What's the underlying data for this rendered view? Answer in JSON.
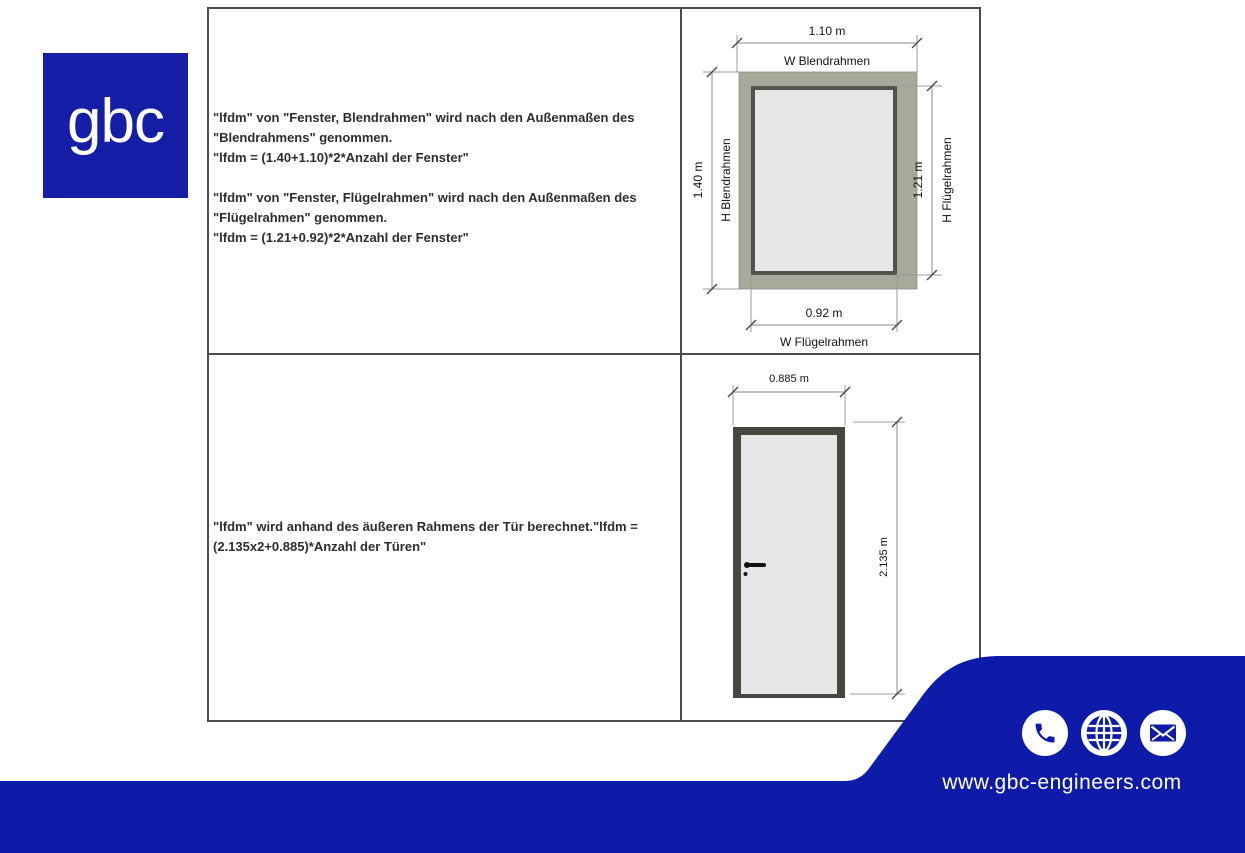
{
  "logo": {
    "text": "gbc"
  },
  "colors": {
    "brand_blue": "#0e1ba8",
    "logo_blue": "#161da7",
    "window_outer_frame": "#a8a99b",
    "window_inner_frame": "#53534c",
    "glass": "#e4e6e8",
    "door_frame": "#47473f",
    "door_panel": "#e4e6e8",
    "table_border": "#4c4c4c"
  },
  "table": {
    "window_row": {
      "para1": "\"lfdm\" von \"Fenster, Blendrahmen\" wird nach den Außenmaßen des \"Blendrahmens\" genommen.",
      "para2": "\"lfdm = (1.40+1.10)*2*Anzahl der Fenster\"",
      "para3": "\"lfdm\" von \"Fenster, Flügelrahmen\" wird nach den Außenmaßen des \"Flügelrahmen\" genommen.",
      "para4": "\"lfdm = (1.21+0.92)*2*Anzahl der Fenster\""
    },
    "door_row": {
      "para1": "\"lfdm\" wird anhand des äußeren Rahmens der Tür berechnet.\"lfdm = (2.135x2+0.885)*Anzahl der Türen\""
    }
  },
  "window_diagram": {
    "width_outer": "1.10 m",
    "width_outer_label": "W Blendrahmen",
    "height_outer": "1.40 m",
    "height_outer_label": "H Blendrahmen",
    "height_inner": "1.21 m",
    "height_inner_label": "H Flügelrahmen",
    "width_inner": "0.92 m",
    "width_inner_label": "W Flügelrahmen"
  },
  "door_diagram": {
    "width": "0.885 m",
    "height": "2.135 m"
  },
  "footer": {
    "url": "www.gbc-engineers.com",
    "icons": [
      "phone",
      "globe",
      "email"
    ]
  }
}
